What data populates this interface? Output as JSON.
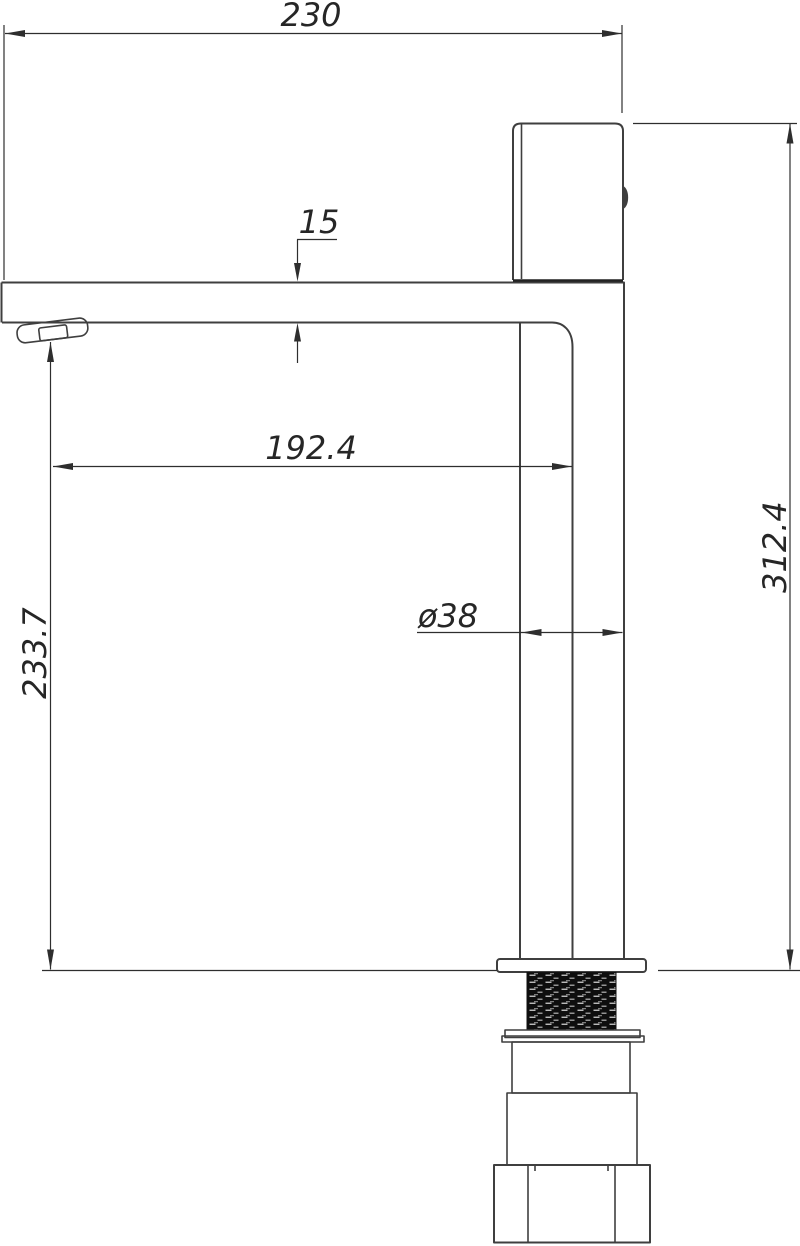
{
  "figure": {
    "type": "technical-drawing",
    "subject": "tall single-lever basin mixer tap, side elevation with dimensions",
    "units": "mm",
    "dimensions": {
      "overall_width": "230",
      "spout_thickness": "15",
      "spout_reach": "192.4",
      "body_diameter": "ø38",
      "outlet_height": "233.7",
      "overall_height": "312.4"
    },
    "colors": {
      "line": "#3f3f3f",
      "dim": "#2e2e2e",
      "text": "#262626",
      "thread": "#0e0e0e",
      "background": "#ffffff"
    }
  }
}
